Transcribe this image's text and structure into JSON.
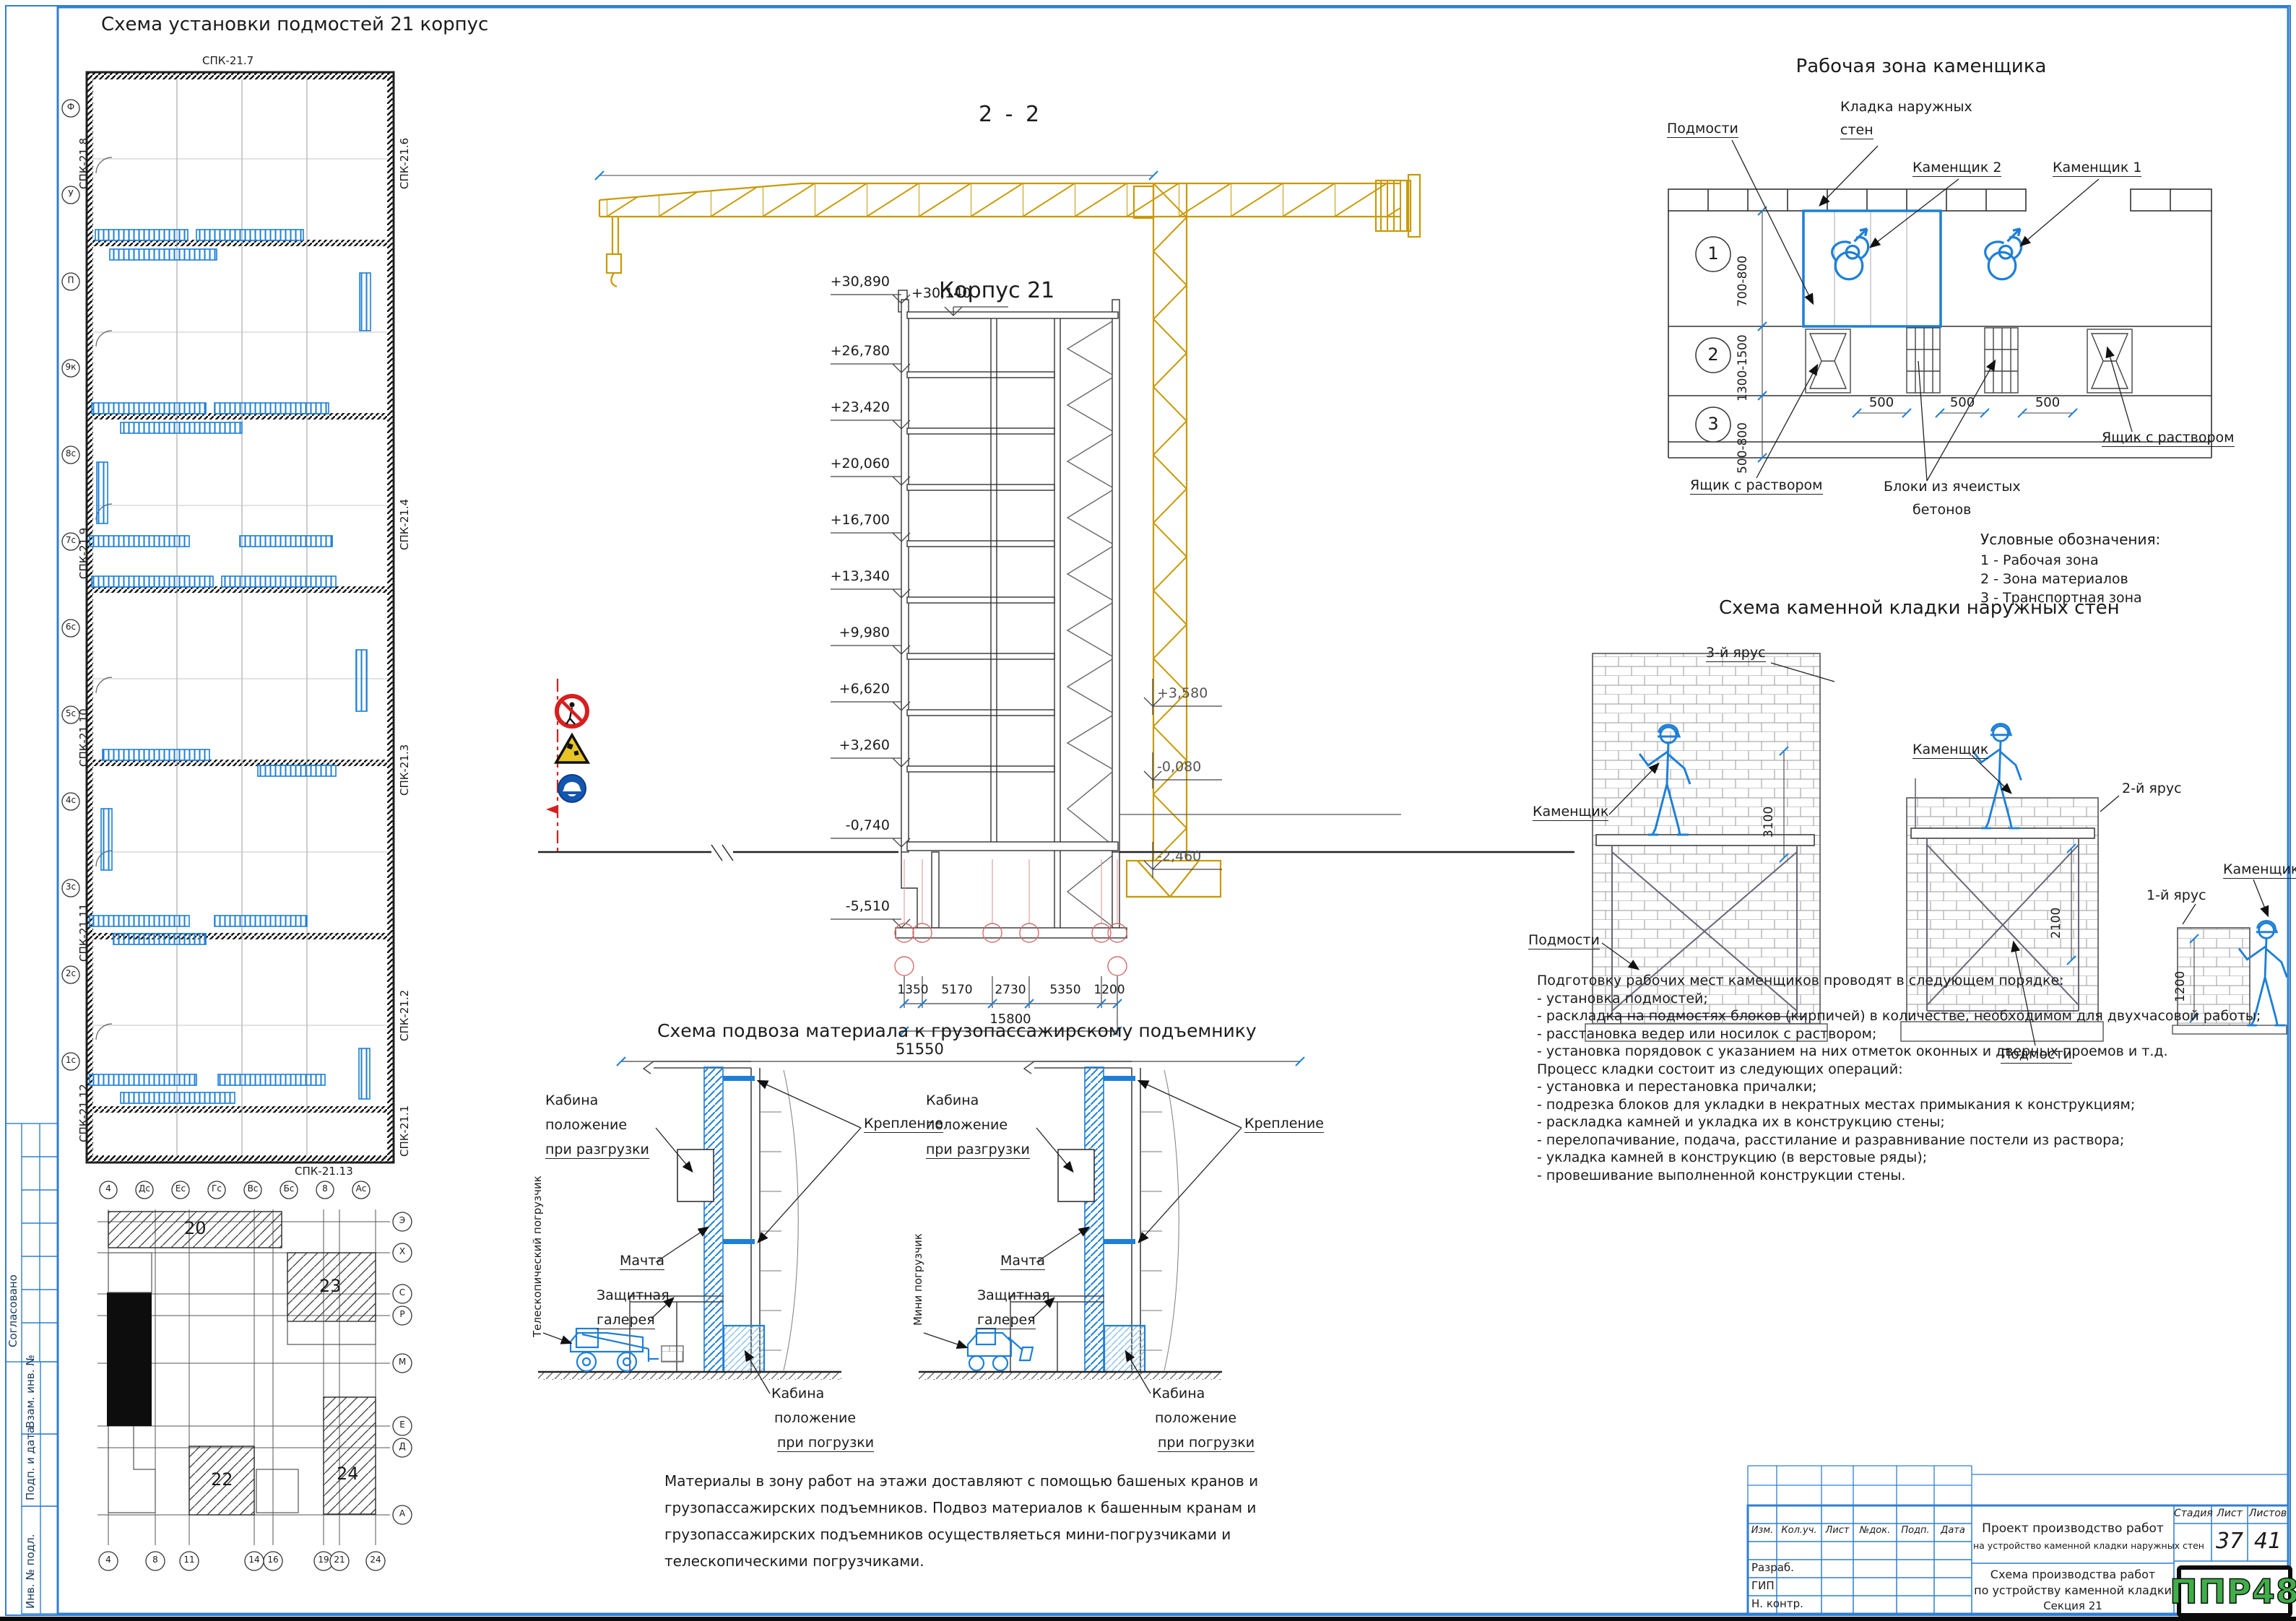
{
  "sheet": {
    "title": "Схема установки подмостей 21 корпус"
  },
  "floor_plan": {
    "spk_top": "СПК-21.7",
    "spk_bottom": "СПК-21.13",
    "spk_left": [
      "СПК-21.8",
      "СПК-21.9",
      "СПК-21.10",
      "СПК-21.11",
      "СПК-21.12"
    ],
    "spk_right": [
      "СПК-21.6",
      "СПК-21.4",
      "СПК-21.3",
      "СПК-21.2",
      "СПК-21.1"
    ],
    "axis_left": [
      "Ф",
      "У",
      "П",
      "9к",
      "8с",
      "7с",
      "6с",
      "5с",
      "4с",
      "3с",
      "2с",
      "1с"
    ],
    "axis_bottom": [
      "4",
      "Дс",
      "Ес",
      "Гс",
      "Вс",
      "Бс",
      "8",
      "Ас"
    ]
  },
  "key_plan": {
    "areas": [
      "20",
      "23",
      "22",
      "24"
    ],
    "axis_bottom": [
      "4",
      "8",
      "11",
      "14",
      "16",
      "19",
      "21",
      "24"
    ],
    "axis_right": [
      "Э",
      "Х",
      "С",
      "Р",
      "М",
      "Е",
      "Д",
      "А"
    ]
  },
  "section": {
    "title": "2 - 2",
    "building": "Корпус 21",
    "elev_left": [
      "+30,890",
      "+26,780",
      "+23,420",
      "+20,060",
      "+16,700",
      "+13,340",
      "+9,980",
      "+6,620",
      "+3,260",
      "-0,740",
      "-5,510"
    ],
    "elev_roof": "+30,140",
    "elev_crane": [
      "+3,580",
      "-0,080",
      "-2,460"
    ],
    "dims": [
      "1350",
      "5170",
      "2730",
      "5350",
      "1200"
    ],
    "dim_total1": "15800",
    "dim_total2": "51550"
  },
  "work_zone": {
    "title": "Рабочая зона каменщика",
    "podmosti": "Подмости",
    "kladka1": "Кладка наружных",
    "kladka2": "стен",
    "mason2": "Каменщик 2",
    "mason1": "Каменщик 1",
    "yashik_right": "Ящик с раствором",
    "yashik_left": "Ящик с раствором",
    "bloki1": "Блоки из ячеистых",
    "bloki2": "бетонов",
    "zones": [
      "1",
      "2",
      "3"
    ],
    "zone_dims": [
      "700-800",
      "1300-1500",
      "500-800"
    ],
    "dim_500": "500",
    "legend_title": "Условные обозначения:",
    "legend": [
      "1 - Рабочая зона",
      "2 - Зона материалов",
      "3 - Транспортная зона"
    ]
  },
  "masonry": {
    "title": "Схема каменной кладки наружных стен",
    "tiers": [
      "3-й ярус",
      "2-й ярус",
      "1-й ярус"
    ],
    "mason": "Каменщик",
    "podmosti": "Подмости",
    "dims": [
      "3100",
      "2100",
      "1200"
    ]
  },
  "hoist": {
    "title": "Схема подвоза материала к грузопассажирскому подъемнику",
    "cab_unload": [
      "Кабина",
      "положение",
      "при разгрузки"
    ],
    "cab_load": [
      "Кабина",
      "положение",
      "при погрузки"
    ],
    "kreplenie": "Крепление",
    "machta": "Мачта",
    "gallery": [
      "Защитная",
      "галерея"
    ],
    "loader_left": "Телескопический погрузчик",
    "loader_right": "Мини погрузчик"
  },
  "materials_note": [
    "Материалы в зону работ на этажи доставляют с помощью башеных кранов и",
    "грузопассажирских подъемников. Подвоз материалов к башенным кранам и",
    "грузопассажирских  подъемников  осуществляеться  мини-погрузчиками  и",
    "телескопическими погрузчиками."
  ],
  "procedure": [
    "Подготовку рабочих мест каменщиков проводят в следующем порядке:",
    "- установка подмостей;",
    "- раскладка на подмостях блоков (кирпичей) в количестве, необходимом для двухчасовой работы;",
    "- расстановка ведер или носилок с раствором;",
    "- установка порядовок с указанием на них отметок оконных и дверных проемов и т.д.",
    "Процесс кладки состоит из следующих операций:",
    "- установка и перестановка причалки;",
    "- подрезка блоков для укладки в некратных местах примыкания к конструкциям;",
    "- раскладка камней и укладка их в конструкцию стены;",
    "- перелопачивание, подача, расстилание и разравнивание постели из раствора;",
    "- укладка камней в конструкцию (в верстовые ряды);",
    "- провешивание выполненной конструкции стены."
  ],
  "stamp": {
    "header_cols": [
      "Изм.",
      "Кол.уч.",
      "Лист",
      "№док.",
      "Подп.",
      "Дата"
    ],
    "project1": "Проект производство работ",
    "project2": "на устройство каменной кладки наружных стен",
    "stage_cols": [
      "Стадия",
      "Лист",
      "Листов"
    ],
    "sheet_no": "37",
    "sheets_total": "41",
    "doc1": "Схема производства работ",
    "doc2": "по устройству каменной кладки",
    "doc3": "Секция 21",
    "roles": [
      "Разраб.",
      "ГИП",
      "Н. контр."
    ],
    "logo": "ППР48"
  },
  "margin": {
    "labels": [
      "Согласовано",
      "Взам. инв. №",
      "Подп. и дата",
      "Инв. № подл."
    ]
  }
}
